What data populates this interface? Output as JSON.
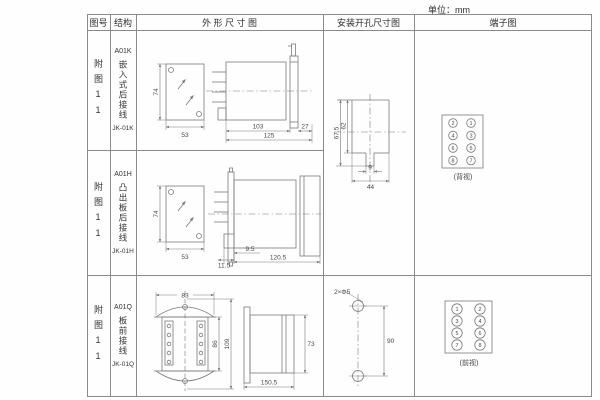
{
  "unit_label": "单位：mm",
  "headers": {
    "fig_no": "图号",
    "structure": "结构",
    "outline": "外 形 尺 寸 图",
    "install": "安装开孔尺寸图",
    "terminal": "端子图"
  },
  "rows": [
    {
      "fig_no": "附图11",
      "model": "A01K",
      "structure": "嵌入式后接线",
      "code": "JK-01K",
      "dims": {
        "front_h": "74",
        "front_w": "53",
        "side_a": "103",
        "side_b": "27",
        "side_c": "125"
      }
    },
    {
      "fig_no": "附图11",
      "model": "A01H",
      "structure": "凸出板后接线",
      "code": "JK-01H",
      "dims": {
        "front_h": "74",
        "front_w": "53",
        "side_a": "11.5",
        "side_b": "9.5",
        "side_c": "120.5"
      }
    },
    {
      "fig_no": "附图11",
      "model": "A01Q",
      "structure": "板前接线",
      "code": "JK-01Q",
      "dims": {
        "front_top": "83",
        "front_inner_h": "86",
        "front_outer_h": "109",
        "side_len": "150.5",
        "side_h": "73"
      }
    }
  ],
  "install_kh": {
    "outer_h": "67.5",
    "inner_h": "62",
    "notch_w": "9",
    "cut_w": "44"
  },
  "install_q": {
    "hole_label": "2×Φ5",
    "spacing": "90"
  },
  "terminal_kh": {
    "numbers": [
      "2",
      "1",
      "4",
      "3",
      "6",
      "5",
      "8",
      "7"
    ],
    "view_label": "(背视)"
  },
  "terminal_q": {
    "numbers": [
      "1",
      "2",
      "3",
      "4",
      "5",
      "6",
      "7",
      "8"
    ],
    "view_label": "(前视)"
  }
}
